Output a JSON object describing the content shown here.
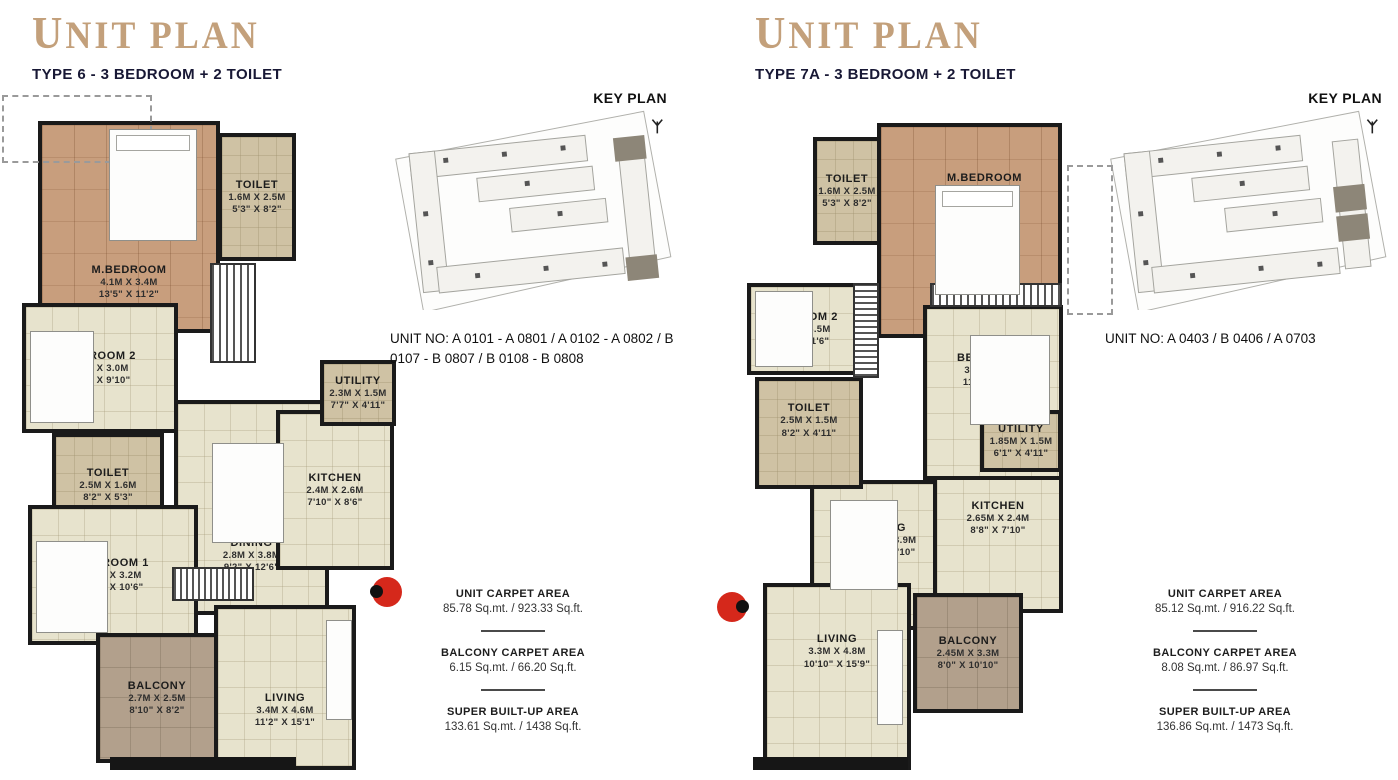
{
  "colors": {
    "accent_title": "#c3a07b",
    "subtitle": "#181835",
    "wall": "#1a1a1a",
    "floor": "#e7e3cd",
    "wood": "#c89e7d",
    "balcony": "#b2a08c",
    "entry_marker": "#d5281b"
  },
  "plans": [
    {
      "title": "UNIT PLAN",
      "subtitle": "TYPE 6 - 3 BEDROOM + 2 TOILET",
      "key_plan_label": "KEY PLAN",
      "unit_no": "UNIT NO: A 0101 - A 0801 / A 0102 - A 0802 / B 0107 - B 0807 / B 0108 - B 0808",
      "rooms": [
        {
          "name": "M.BEDROOM",
          "metric": "4.1M X 3.4M",
          "imperial": "13'5\" X 11'2\""
        },
        {
          "name": "TOILET",
          "metric": "1.6M X 2.5M",
          "imperial": "5'3\" X 8'2\""
        },
        {
          "name": "BEDROOM 2",
          "metric": "3.1M X 3.0M",
          "imperial": "10'2\" X 9'10\""
        },
        {
          "name": "TOILET",
          "metric": "2.5M X 1.6M",
          "imperial": "8'2\" X 5'3\""
        },
        {
          "name": "BEDROOM 1",
          "metric": "3.0M X 3.2M",
          "imperial": "9'10\" X 10'6\""
        },
        {
          "name": "BALCONY",
          "metric": "2.7M X 2.5M",
          "imperial": "8'10\" X 8'2\""
        },
        {
          "name": "LIVING",
          "metric": "3.4M X 4.6M",
          "imperial": "11'2\" X 15'1\""
        },
        {
          "name": "DINING",
          "metric": "2.8M X 3.8M",
          "imperial": "9'2\" X 12'6\""
        },
        {
          "name": "KITCHEN",
          "metric": "2.4M X 2.6M",
          "imperial": "7'10\" X 8'6\""
        },
        {
          "name": "UTILITY",
          "metric": "2.3M X 1.5M",
          "imperial": "7'7\" X 4'11\""
        }
      ],
      "areas": [
        {
          "label": "UNIT CARPET AREA",
          "value": "85.78 Sq.mt. / 923.33 Sq.ft."
        },
        {
          "label": "BALCONY CARPET AREA",
          "value": "6.15 Sq.mt. / 66.20 Sq.ft."
        },
        {
          "label": "SUPER BUILT-UP AREA",
          "value": "133.61 Sq.mt. / 1438 Sq.ft."
        }
      ]
    },
    {
      "title": "UNIT PLAN",
      "subtitle": "TYPE 7A - 3 BEDROOM + 2 TOILET",
      "key_plan_label": "KEY PLAN",
      "unit_no": "UNIT NO: A 0403 / B 0406 / A 0703",
      "rooms": [
        {
          "name": "TOILET",
          "metric": "1.6M X 2.5M",
          "imperial": "5'3\" X 8'2\""
        },
        {
          "name": "M.BEDROOM",
          "metric": "4.4M X 3.4M",
          "imperial": "14'5\" X 11'2\""
        },
        {
          "name": "BEDROOM 2",
          "metric": "2.5M X 3.5M",
          "imperial": "8'2\" X 11'6\""
        },
        {
          "name": "BEDROOM 1",
          "metric": "3.4M X 3.2M",
          "imperial": "11'2\" X 10'6\""
        },
        {
          "name": "TOILET",
          "metric": "2.5M X 1.5M",
          "imperial": "8'2\" X 4'11\""
        },
        {
          "name": "UTILITY",
          "metric": "1.85M X 1.5M",
          "imperial": "6'1\" X 4'11\""
        },
        {
          "name": "KITCHEN",
          "metric": "2.65M X 2.4M",
          "imperial": "8'8\" X 7'10\""
        },
        {
          "name": "DINING",
          "metric": "2.35M X 3.9M",
          "imperial": "7'9\" X 12'10\""
        },
        {
          "name": "LIVING",
          "metric": "3.3M X 4.8M",
          "imperial": "10'10\" X 15'9\""
        },
        {
          "name": "BALCONY",
          "metric": "2.45M X 3.3M",
          "imperial": "8'0\" X 10'10\""
        }
      ],
      "areas": [
        {
          "label": "UNIT CARPET AREA",
          "value": "85.12 Sq.mt. / 916.22 Sq.ft."
        },
        {
          "label": "BALCONY CARPET AREA",
          "value": "8.08 Sq.mt. / 86.97 Sq.ft."
        },
        {
          "label": "SUPER BUILT-UP AREA",
          "value": "136.86 Sq.mt. / 1473 Sq.ft."
        }
      ]
    }
  ]
}
